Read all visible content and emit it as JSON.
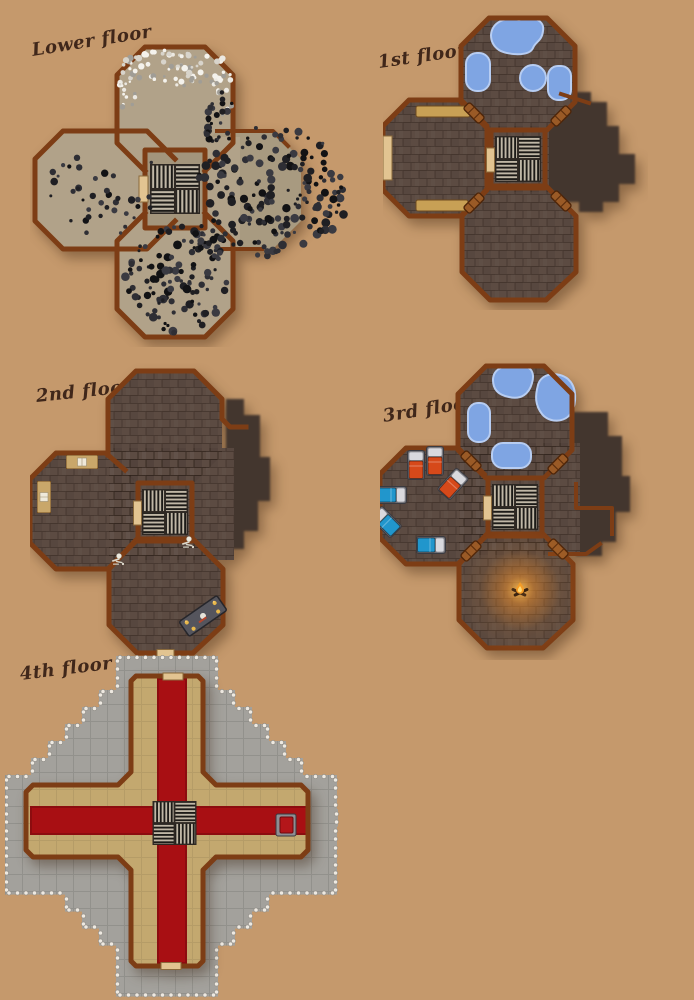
{
  "page": {
    "background_color": "#c5996c"
  },
  "floors": [
    {
      "id": "lower-floor",
      "label": "Lower floor"
    },
    {
      "id": "first-floor",
      "label": "1st floor"
    },
    {
      "id": "second-floor",
      "label": "2nd floor"
    },
    {
      "id": "third-floor",
      "label": "3rd floor"
    },
    {
      "id": "fourth-floor",
      "label": "4th floor"
    }
  ],
  "palette": {
    "wall_brown": "#7d3d15",
    "floor_rubble_tan": "#b1a289",
    "floor_brick_brown": "#5c4b42",
    "floor_shadow_brown": "#43362e",
    "water_blue": "#7fa5e3",
    "carpet_red": "#a80f13",
    "roof_floor_tan": "#c3a86f",
    "battlement_gray": "#a3a19c",
    "bed_red": "#d6491a",
    "bed_blue": "#2196cc",
    "fire_orange": "#f49b26",
    "label_ink": "#40271a"
  }
}
